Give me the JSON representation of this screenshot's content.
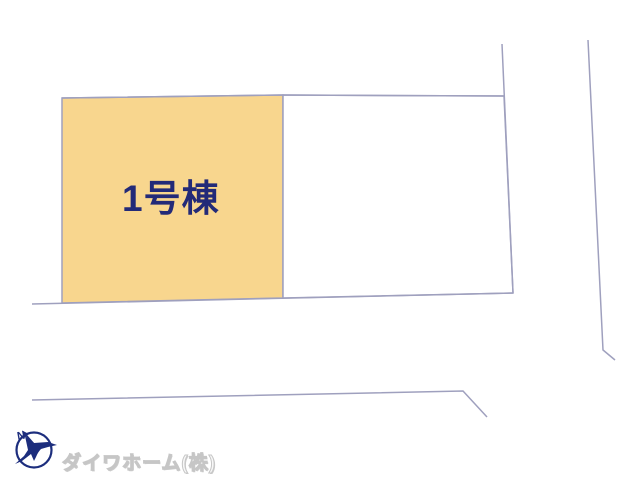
{
  "map": {
    "building_label": "1号棟",
    "company_label": "ダイワホーム(株)",
    "compass_label": "N",
    "colors": {
      "background": "#FFFFFF",
      "parcel_fill": "#F8D68E",
      "building_label_text": "#232A78",
      "boundary_line": "#9FA0BE",
      "compass_navy": "#1C2D7D",
      "company_text": "#CFCFCF"
    }
  }
}
